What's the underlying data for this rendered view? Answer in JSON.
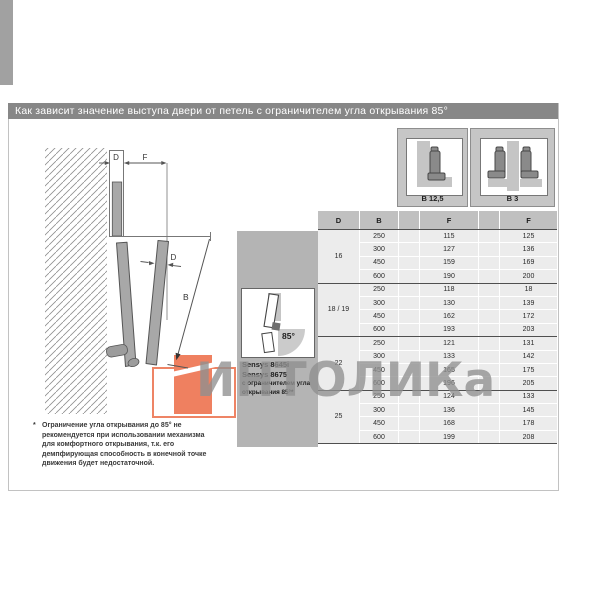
{
  "title": "Как зависит значение выступа двери от петель с ограничителем угла открывания 85°",
  "colors": {
    "accent_orange": "#ef8060",
    "title_bar_gray": "#878787"
  },
  "watermark": {
    "text": "ИНТОЛИКа"
  },
  "diagram": {
    "labels": {
      "d_top": "D",
      "f_top": "F",
      "d_door": "D",
      "b": "B"
    }
  },
  "hinge_headers": [
    {
      "label": "B 12,5"
    },
    {
      "label": "B 3"
    }
  ],
  "table": {
    "columns": [
      "D",
      "B",
      "F",
      "F"
    ],
    "groups": [
      {
        "d": "16",
        "rows": [
          [
            "250",
            "115",
            "125"
          ],
          [
            "300",
            "127",
            "136"
          ],
          [
            "450",
            "159",
            "169"
          ],
          [
            "600",
            "190",
            "200"
          ]
        ]
      },
      {
        "d": "18 / 19",
        "rows": [
          [
            "250",
            "118",
            "18"
          ],
          [
            "300",
            "130",
            "139"
          ],
          [
            "450",
            "162",
            "172"
          ],
          [
            "600",
            "193",
            "203"
          ]
        ]
      },
      {
        "d": "22",
        "rows": [
          [
            "250",
            "121",
            "131"
          ],
          [
            "300",
            "133",
            "142"
          ],
          [
            "450",
            "165",
            "175"
          ],
          [
            "600",
            "196",
            "205"
          ]
        ]
      },
      {
        "d": "25",
        "rows": [
          [
            "250",
            "124",
            "133"
          ],
          [
            "300",
            "136",
            "145"
          ],
          [
            "450",
            "168",
            "178"
          ],
          [
            "600",
            "199",
            "208"
          ]
        ]
      }
    ]
  },
  "product_box": {
    "angle_label": "85°",
    "lines": [
      "Sensys 8645i",
      "Sensys 8675",
      "с ограничителем угла",
      "открывания 85°*"
    ]
  },
  "footnote": {
    "marker": "*",
    "lines": [
      "Ограничение угла открывания до 85° не",
      "рекомендуется при использовании механизма",
      "для комфортного открывания, т.к. его",
      "демпфирующая способность в конечной точке",
      "движения будет недостаточной."
    ]
  }
}
